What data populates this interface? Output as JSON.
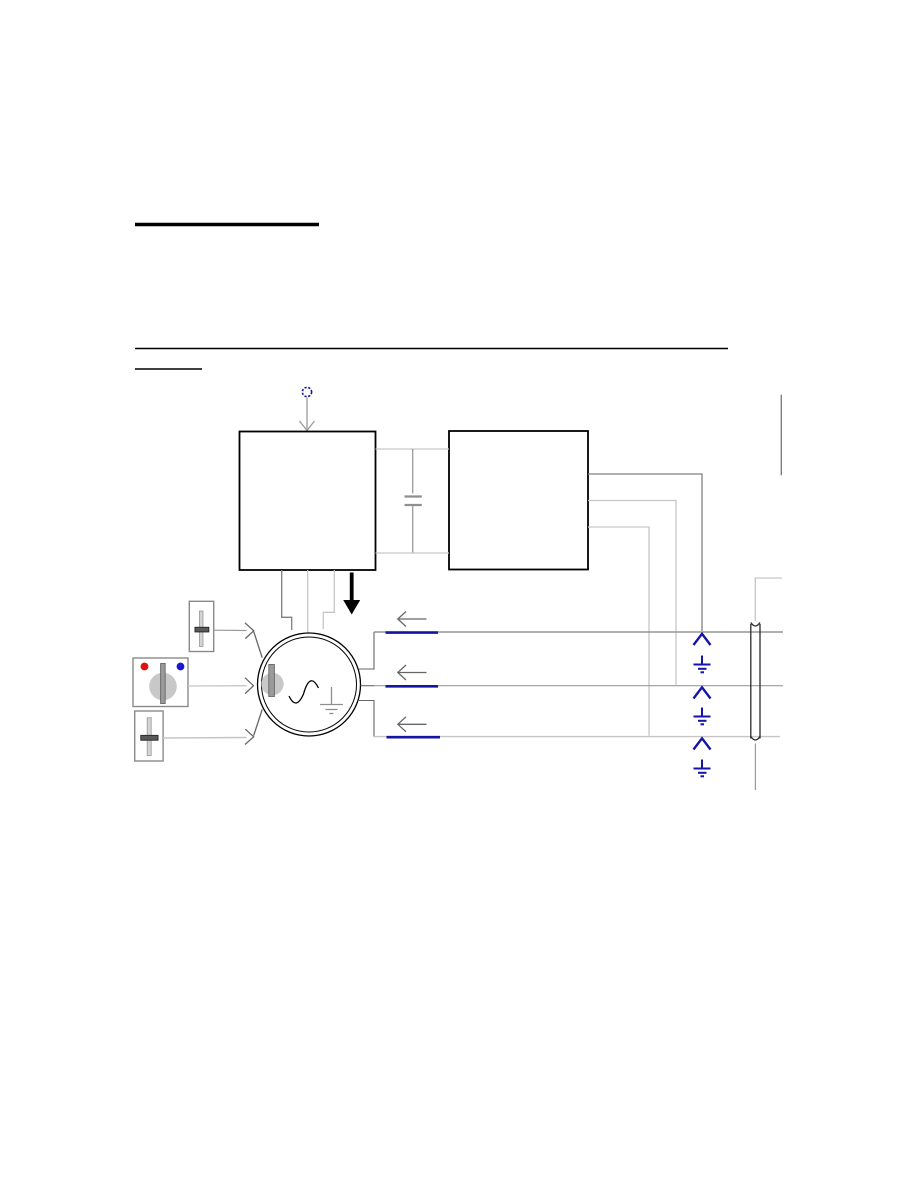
{
  "page": {
    "type": "technical-manual-page",
    "text_content": "",
    "note": "page contains only blank underlined headings and a schematic diagram, no rendered text"
  },
  "colors": {
    "ink": "#000000",
    "wire_dark": "#7f7f7f",
    "wire_mid": "#9b9b9b",
    "wire_light": "#c6c6c6",
    "plate_gray": "#8f8f8f",
    "arrow_gray": "#666666",
    "navy": "#1414a6",
    "red_dot": "#e01010",
    "blue_dot": "#1818cf",
    "control_border": "#8a8a8a",
    "track_gray": "#d4d4d4",
    "knob_gray": "#c8c8c8",
    "bar_gray": "#9a9a9a",
    "handle_dark": "#5a5a5a",
    "cable_ink": "#2a2a2a",
    "white": "#ffffff"
  },
  "diagram": {
    "heading_rules": [
      "thick-blank-title-underline",
      "long-thin-divider-rule",
      "short-blank-subtitle-underline"
    ],
    "components": [
      "input-terminal-dashed-circle",
      "block-a",
      "block-b",
      "capacitor-link",
      "ac-motor-circle",
      "rotor-knob",
      "sine-wave",
      "internal-ground",
      "slider-control-top",
      "rotary-switch-control",
      "slider-control-bottom",
      "output-wire-1",
      "output-wire-2",
      "output-wire-3",
      "blue-wire-highlights",
      "current-direction-arrows",
      "navy-up-arrows",
      "navy-ground-symbols",
      "cable-shield",
      "down-black-arrow"
    ],
    "wire_count": 3,
    "ground_count": 3
  }
}
